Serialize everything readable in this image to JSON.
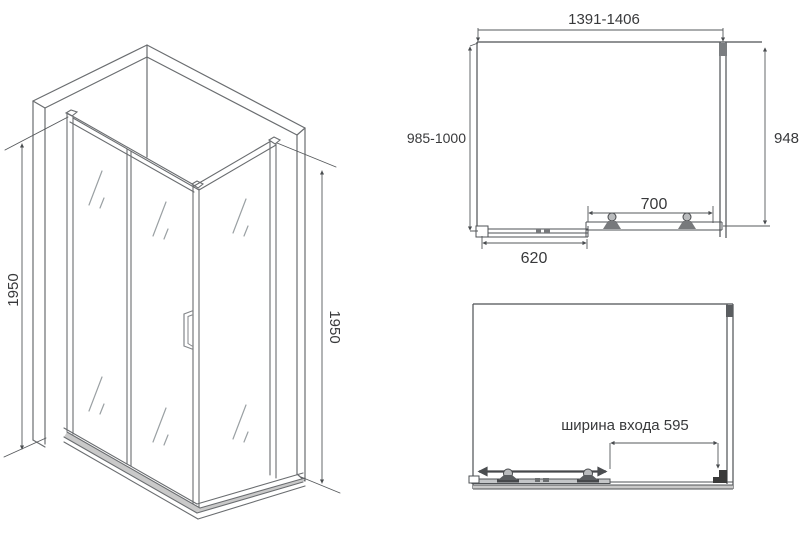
{
  "drawing_title": "shower-enclosure-technical-drawing",
  "colors": {
    "background": "#ffffff",
    "frame_line": "#6a6d70",
    "plan_line": "#4e5154",
    "dim_line": "#55585b",
    "glass_line": "#9aa0a3",
    "text": "#38393b",
    "shade": "#c9c9c9",
    "dark_part": "#3a3a3a"
  },
  "isometric_view": {
    "height_left": "1950",
    "height_right": "1950"
  },
  "top_plan_view": {
    "overall_width": "1391-1406",
    "depth_range": "985-1000",
    "side_panel_depth": "948",
    "door_width": "700",
    "fixed_panel_width": "620"
  },
  "entrance_plan_view": {
    "entrance_width_label": "ширина входа 595"
  }
}
